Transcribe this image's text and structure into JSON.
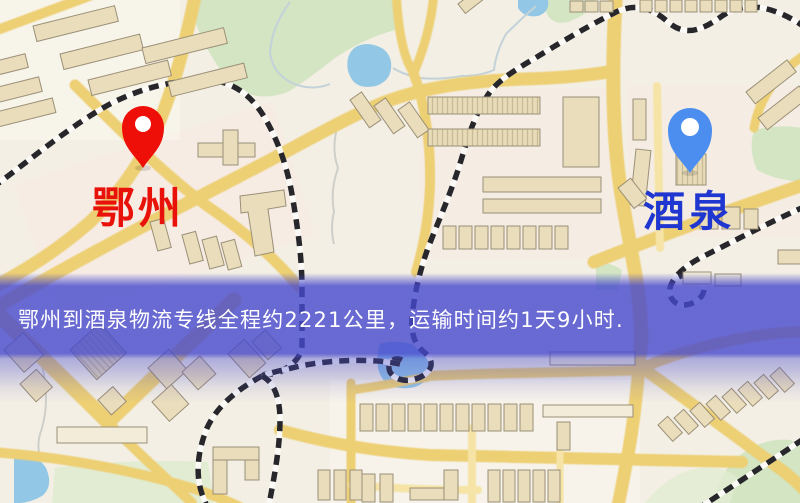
{
  "markers": {
    "origin": {
      "label": "鄂州",
      "pin_color": "#ee1008",
      "label_color": "#e8120a"
    },
    "destination": {
      "label": "酒泉",
      "pin_color": "#4b8ef0",
      "label_color": "#2036d0"
    }
  },
  "banner": {
    "text": "鄂州到酒泉物流专线全程约2221公里，运输时间约1天9小时.",
    "distance_text": "约2221公里",
    "duration_text": "约1天9小时",
    "background_color": "#4648cd",
    "text_color": "#ffffff"
  },
  "map": {
    "type": "street-map",
    "palette": {
      "background": "#f3efe4",
      "road": "#edcf74",
      "road_minor": "#f5e4a6",
      "building": "#eaddbc",
      "building_outline": "#9b9077",
      "park": "#d3e5c3",
      "water": "#93c7e6",
      "railway_dash": "#27272b"
    }
  }
}
